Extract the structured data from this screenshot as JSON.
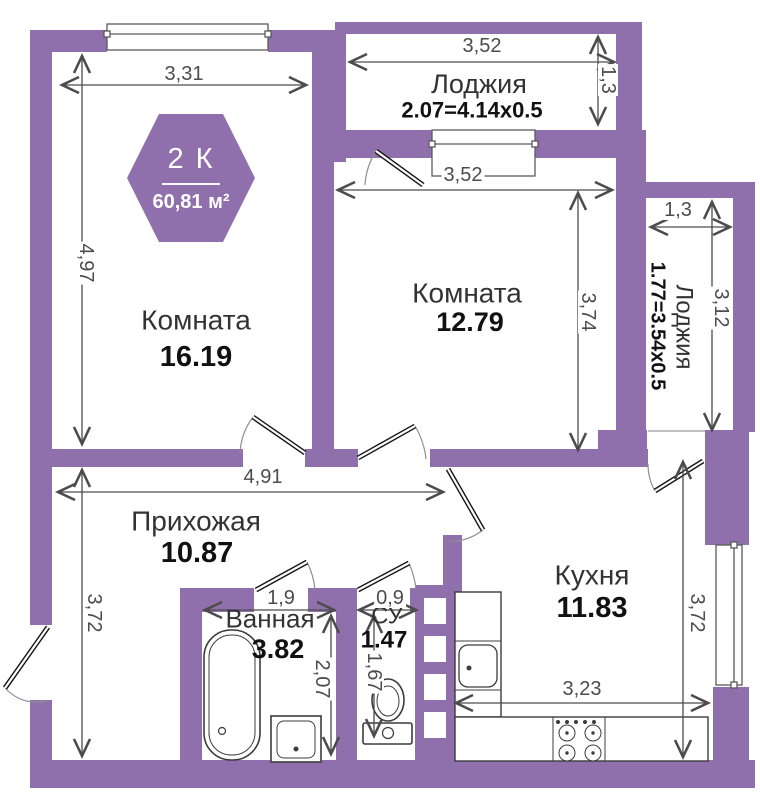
{
  "badge": {
    "rooms_label": "2 К",
    "area": "60,81 м²"
  },
  "rooms": {
    "room1": {
      "name": "Комната",
      "area": "16.19"
    },
    "room2": {
      "name": "Комната",
      "area": "12.79"
    },
    "loggia_top": {
      "name": "Лоджия",
      "area": "2.07=4.14x0.5"
    },
    "loggia_right": {
      "name": "Лоджия",
      "area": "1.77=3.54x0.5"
    },
    "hall": {
      "name": "Прихожая",
      "area": "10.87"
    },
    "bath": {
      "name": "Ванная",
      "area": "3.82"
    },
    "wc": {
      "name": "СУ",
      "area": "1.47"
    },
    "kitchen": {
      "name": "Кухня",
      "area": "11.83"
    }
  },
  "dims": {
    "room1_w": "3,31",
    "room1_h": "4,97",
    "loggia_top_w": "3,52",
    "loggia_top_d": "1,3",
    "room2_w": "3,52",
    "room2_h": "3,74",
    "loggia_right_w": "1,3",
    "loggia_right_h": "3,12",
    "hall_w": "4,91",
    "hall_h": "3,72",
    "bath_w": "1,9",
    "bath_h": "2,07",
    "wc_w": "0,9",
    "wc_h": "1,67",
    "kitchen_w": "3,23",
    "kitchen_h": "3,72"
  },
  "colors": {
    "wall": "#8f70ad",
    "dim_line": "#4c4c4c",
    "label_text": "#333333",
    "number_text": "#111111"
  }
}
